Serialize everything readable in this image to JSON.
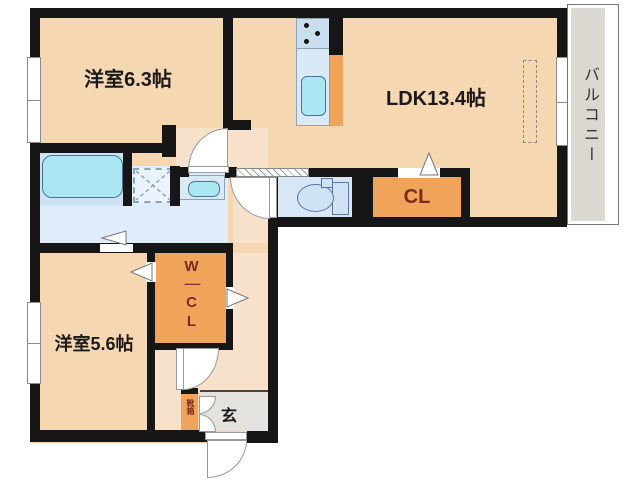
{
  "floor_plan": {
    "labels": {
      "bedroom1": "洋室6.3帖",
      "ldk": "LDK13.4帖",
      "bedroom2": "洋室5.6帖",
      "closet": "CL",
      "walk_in_closet": "W｜CL",
      "entrance": "玄",
      "shoe_cabinet": "靴箱",
      "balcony": "バルコニー"
    },
    "colors": {
      "wall": "#161616",
      "room_fill": "#F5D7B2",
      "hall_fill": "#F8E1CA",
      "closet_fill": "#F0A45A",
      "closet_label": "#7B2A1F",
      "wet_area_fill": "#DFECF9",
      "fixture_fill": "#ABE7F2",
      "balcony_fill": "#DBD7D1"
    }
  }
}
